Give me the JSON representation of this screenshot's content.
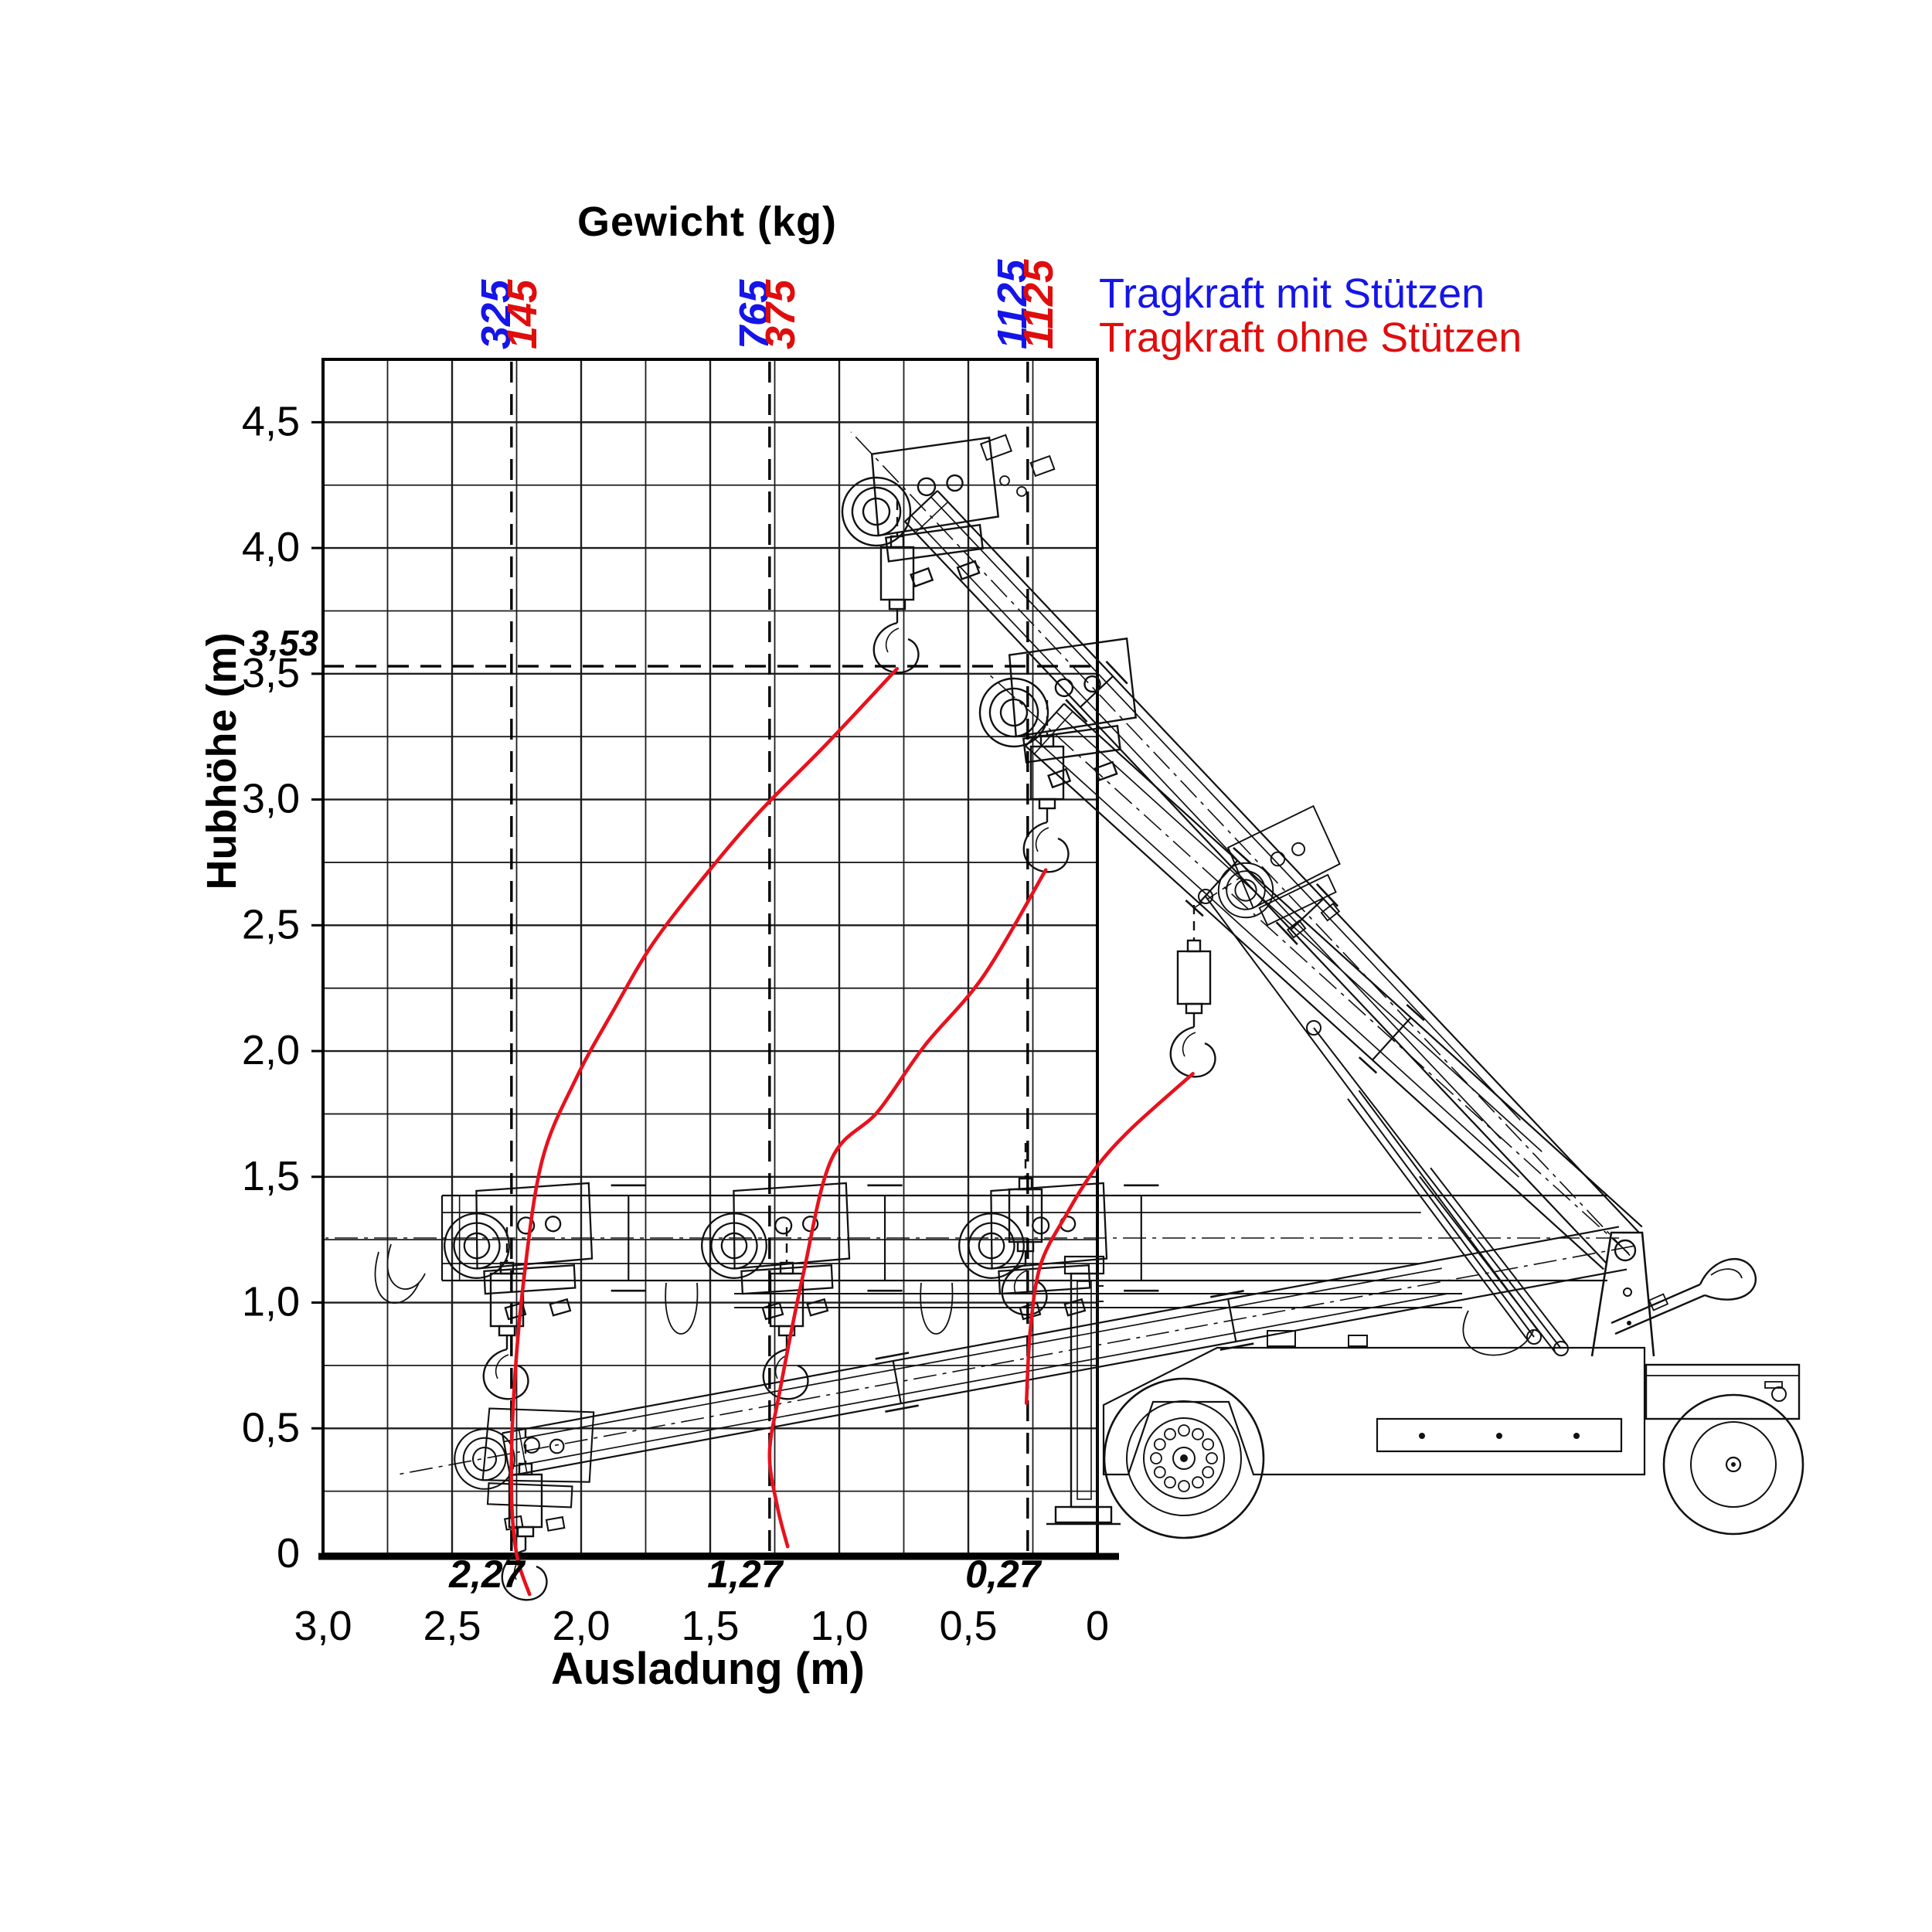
{
  "title": "Gewicht (kg)",
  "legend": {
    "with_supports": {
      "label": "Tragkraft mit Stützen",
      "color": "#1515e8"
    },
    "without_supports": {
      "label": "Tragkraft ohne Stützen",
      "color": "#e00d0d"
    }
  },
  "y_axis": {
    "label": "Hubhöhe (m)",
    "ticks": [
      {
        "value": 4.5,
        "label": "4,5"
      },
      {
        "value": 4.0,
        "label": "4,0"
      },
      {
        "value": 3.5,
        "label": "3,5"
      },
      {
        "value": 3.0,
        "label": "3,0"
      },
      {
        "value": 2.5,
        "label": "2,5"
      },
      {
        "value": 2.0,
        "label": "2,0"
      },
      {
        "value": 1.5,
        "label": "1,5"
      },
      {
        "value": 1.0,
        "label": "1,0"
      },
      {
        "value": 0.5,
        "label": "0,5"
      },
      {
        "value": 0.0,
        "label": "0"
      }
    ],
    "special_height": {
      "value": 3.53,
      "label": "3,53"
    }
  },
  "x_axis": {
    "label": "Ausladung (m)",
    "ticks": [
      {
        "value": 3.0,
        "label": "3,0"
      },
      {
        "value": 2.5,
        "label": "2,5"
      },
      {
        "value": 2.0,
        "label": "2,0"
      },
      {
        "value": 1.5,
        "label": "1,5"
      },
      {
        "value": 1.0,
        "label": "1,0"
      },
      {
        "value": 0.5,
        "label": "0,5"
      },
      {
        "value": 0.0,
        "label": "0"
      }
    ]
  },
  "chart_data": {
    "type": "line",
    "title": "Gewicht (kg)",
    "xlabel": "Ausladung (m)",
    "ylabel": "Hubhöhe (m)",
    "x_range": [
      0,
      3.0
    ],
    "y_range": [
      0,
      4.75
    ],
    "grid_step": 0.25,
    "x_axis_reversed": true,
    "grid": true,
    "max_hook_height": {
      "value": 3.53,
      "label": "3,53"
    },
    "capacity_columns": [
      {
        "outreach_m": 2.27,
        "outreach_label": "2,27",
        "with_supports_kg": 325,
        "with_label": "325",
        "without_supports_kg": 145,
        "without_label": "145"
      },
      {
        "outreach_m": 1.27,
        "outreach_label": "1,27",
        "with_supports_kg": 765,
        "with_label": "765",
        "without_supports_kg": 375,
        "without_label": "375"
      },
      {
        "outreach_m": 0.27,
        "outreach_label": "0,27",
        "with_supports_kg": 1125,
        "with_label": "1125",
        "without_supports_kg": 1125,
        "without_label": "1125"
      }
    ],
    "curve_color": "#e8111d",
    "hook_path_curves": [
      {
        "name": "hook-path-outreach-2.27",
        "points_m": [
          [
            0.776,
            3.52
          ],
          [
            1.05,
            3.22
          ],
          [
            1.31,
            2.95
          ],
          [
            1.51,
            2.71
          ],
          [
            1.72,
            2.43
          ],
          [
            1.87,
            2.17
          ],
          [
            2.02,
            1.89
          ],
          [
            2.15,
            1.57
          ],
          [
            2.22,
            1.11
          ],
          [
            2.26,
            0.65
          ],
          [
            2.27,
            0.25
          ],
          [
            2.25,
            0.0
          ],
          [
            2.2,
            -0.16
          ]
        ]
      },
      {
        "name": "hook-path-outreach-1.27",
        "points_m": [
          [
            0.2,
            2.72
          ],
          [
            0.44,
            2.3
          ],
          [
            0.67,
            2.02
          ],
          [
            0.85,
            1.76
          ],
          [
            1.03,
            1.57
          ],
          [
            1.14,
            1.11
          ],
          [
            1.23,
            0.65
          ],
          [
            1.27,
            0.4
          ],
          [
            1.24,
            0.19
          ],
          [
            1.2,
            0.03
          ]
        ]
      },
      {
        "name": "hook-path-outreach-0.27",
        "points_m": [
          [
            -0.37,
            1.91
          ],
          [
            -0.13,
            1.69
          ],
          [
            0.01,
            1.53
          ],
          [
            0.12,
            1.35
          ],
          [
            0.22,
            1.15
          ],
          [
            0.26,
            0.89
          ],
          [
            0.275,
            0.6
          ]
        ]
      }
    ]
  }
}
